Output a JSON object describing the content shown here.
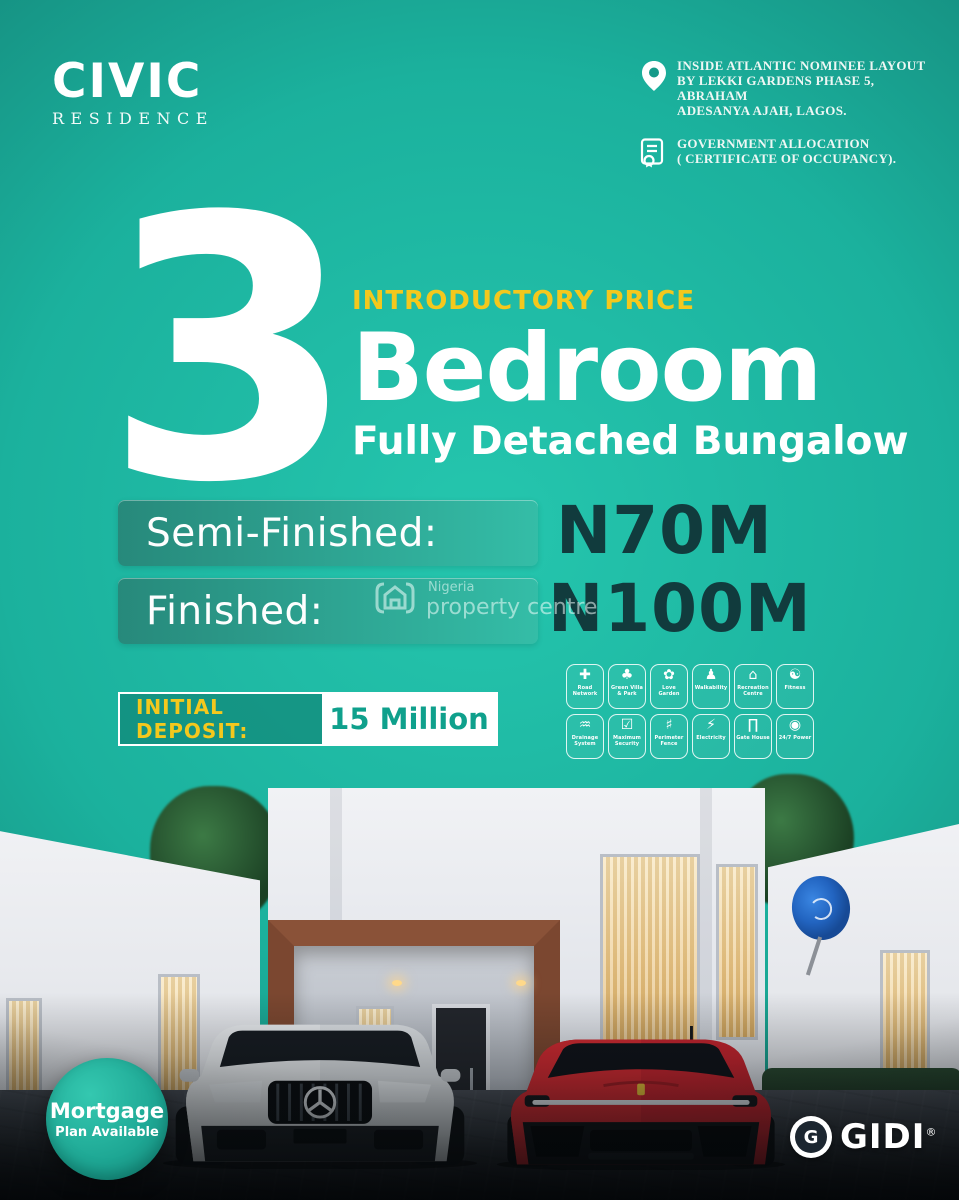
{
  "brand": {
    "name": "CIVIC",
    "sub": "RESIDENCE"
  },
  "header": {
    "location": {
      "icon": "location-pin-icon",
      "line1": "INSIDE ATLANTIC NOMINEE LAYOUT",
      "line2": "BY LEKKI GARDENS PHASE 5, ABRAHAM",
      "line3": "ADESANYA AJAH, LAGOS."
    },
    "allocation": {
      "icon": "certificate-icon",
      "line1": "GOVERNMENT ALLOCATION",
      "line2": "( CERTIFICATE OF OCCUPANCY)."
    }
  },
  "hero": {
    "number": "3",
    "eyebrow": "INTRODUCTORY PRICE",
    "title": "Bedroom",
    "subtitle": "Fully Detached Bungalow"
  },
  "pricing": {
    "rows": [
      {
        "label": "Semi-Finished:",
        "value": "N70M"
      },
      {
        "label": "Finished:",
        "value": "N100M"
      }
    ]
  },
  "watermark": {
    "icon": "house-logo-icon",
    "top": "Nigeria",
    "bottom": "property centre"
  },
  "deposit": {
    "label": "INITIAL DEPOSIT:",
    "value": "15 Million"
  },
  "amenities": {
    "rows": [
      [
        {
          "icon": "road-network",
          "label": "Road Network"
        },
        {
          "icon": "green-villa-park",
          "label": "Green Villa & Park"
        },
        {
          "icon": "love-garden",
          "label": "Love Garden"
        },
        {
          "icon": "walkability",
          "label": "Walkability"
        },
        {
          "icon": "recreation-centre",
          "label": "Recreation Centre"
        },
        {
          "icon": "fitness",
          "label": "Fitness"
        }
      ],
      [
        {
          "icon": "drainage-system",
          "label": "Drainage System"
        },
        {
          "icon": "maximum-security",
          "label": "Maximum Security"
        },
        {
          "icon": "perimeter-fence",
          "label": "Perimeter Fence"
        },
        {
          "icon": "electricity",
          "label": "Electricity"
        },
        {
          "icon": "gate-house",
          "label": "Gate House"
        },
        {
          "icon": "24-7-power",
          "label": "24/7 Power"
        }
      ]
    ]
  },
  "badges": {
    "mortgage": {
      "line1": "Mortgage",
      "line2": "Plan Available"
    },
    "publisher": {
      "emblem_letter": "G",
      "name": "GIDI",
      "reg": "®"
    }
  },
  "colors": {
    "teal_bright": "#25c6ae",
    "teal_dark": "#0f655d",
    "accent_yellow": "#f4c81d",
    "price_value_dark": "#113b3d",
    "deposit_value_green": "#0fa08c"
  }
}
